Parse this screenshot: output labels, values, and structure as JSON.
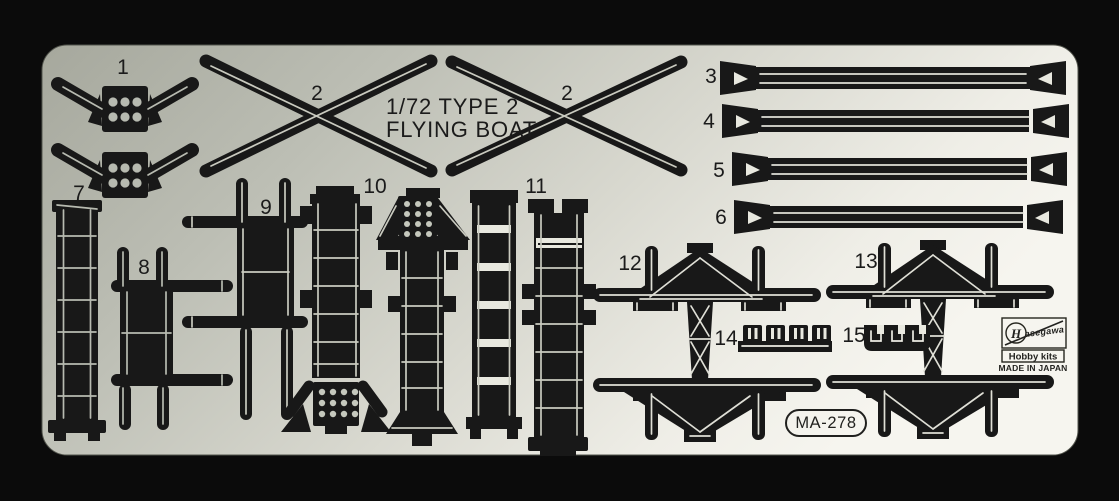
{
  "title": {
    "line1": "1/72 TYPE 2",
    "line2": "FLYING BOAT"
  },
  "labels": [
    "1",
    "2",
    "2",
    "3",
    "4",
    "5",
    "6",
    "7",
    "8",
    "9",
    "10",
    "11",
    "12",
    "13",
    "14",
    "15"
  ],
  "code": "MA-278",
  "brand": {
    "logo_initial": "H",
    "logo_script": "asegawa",
    "kits_label": "Hobby kits",
    "origin": "MADE IN JAPAN"
  },
  "colors": {
    "background": "#0b0b0b",
    "sheet_dark": "#a6a89d",
    "sheet_light": "#f6f5ef",
    "etch_dark": "#181818"
  }
}
